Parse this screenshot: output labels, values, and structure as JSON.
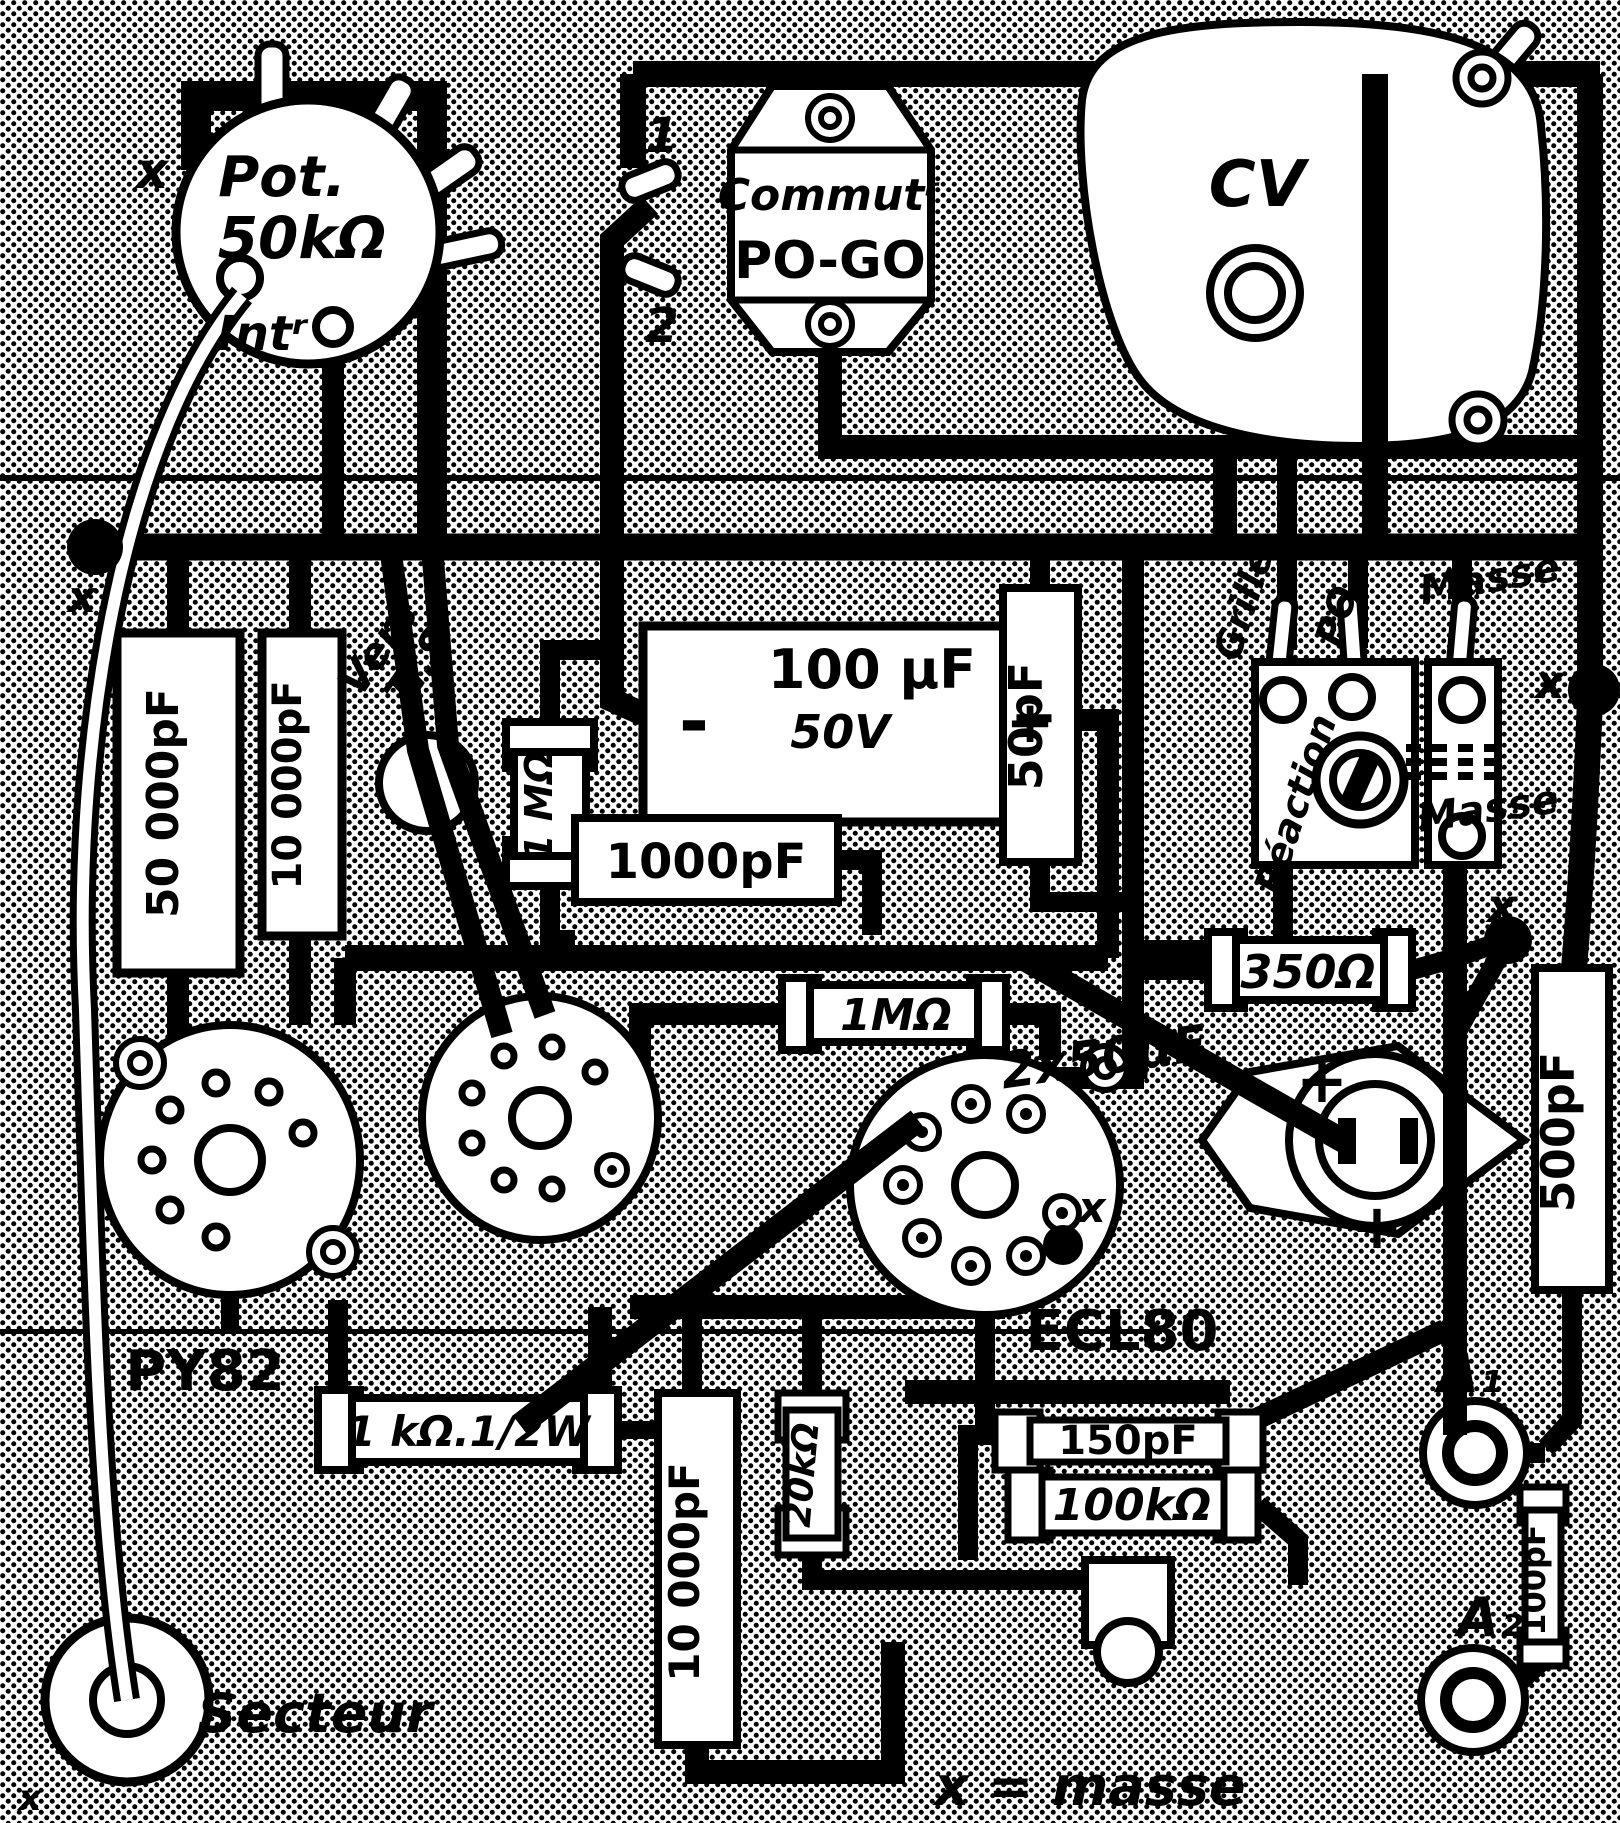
{
  "diagram": {
    "type": "vintage radio chassis wiring diagram (French, halftone print)",
    "tubes": [
      "PY82",
      "ECL80"
    ],
    "ink_color": "#000000",
    "paper_color": "#ffffff"
  },
  "labels": {
    "pot_title": "Pot.",
    "pot_value": "50kΩ",
    "pot_int": "Intʳ",
    "x_mark": "x",
    "tab1": "1",
    "tab2": "2",
    "commut_title": "Commutʳ",
    "commut_range": "PO-GO",
    "cv": "CV",
    "cap50000": "50 000pF",
    "cap10000_left": "10 000pF",
    "vers1": "Vers",
    "vers2": "Tr.S",
    "r1m_vert": "1 MΩ",
    "c100uf": "100 µF",
    "c100uf_volt": "50V",
    "minus": "-",
    "plus": "+",
    "c1000": "1000pF",
    "c50": "50pF",
    "grille": "Grille",
    "po": "PO",
    "masse": "Masse",
    "reaction": "Réaction",
    "r350": "350Ω",
    "c500": "500pF",
    "r1m_mid": "1MΩ",
    "c2x50": "2x50µF",
    "ecl80": "ECL80",
    "py82": "PY82",
    "r1k": "1 kΩ.1/2W",
    "cap10000_bottom": "10 000pF",
    "r20k": "20kΩ",
    "c150": "150pF",
    "r100k": "100kΩ",
    "a1": "A₁",
    "a2": "A₂",
    "c100": "100pF",
    "secteur": "Secteur",
    "ground_note": "x = masse"
  }
}
